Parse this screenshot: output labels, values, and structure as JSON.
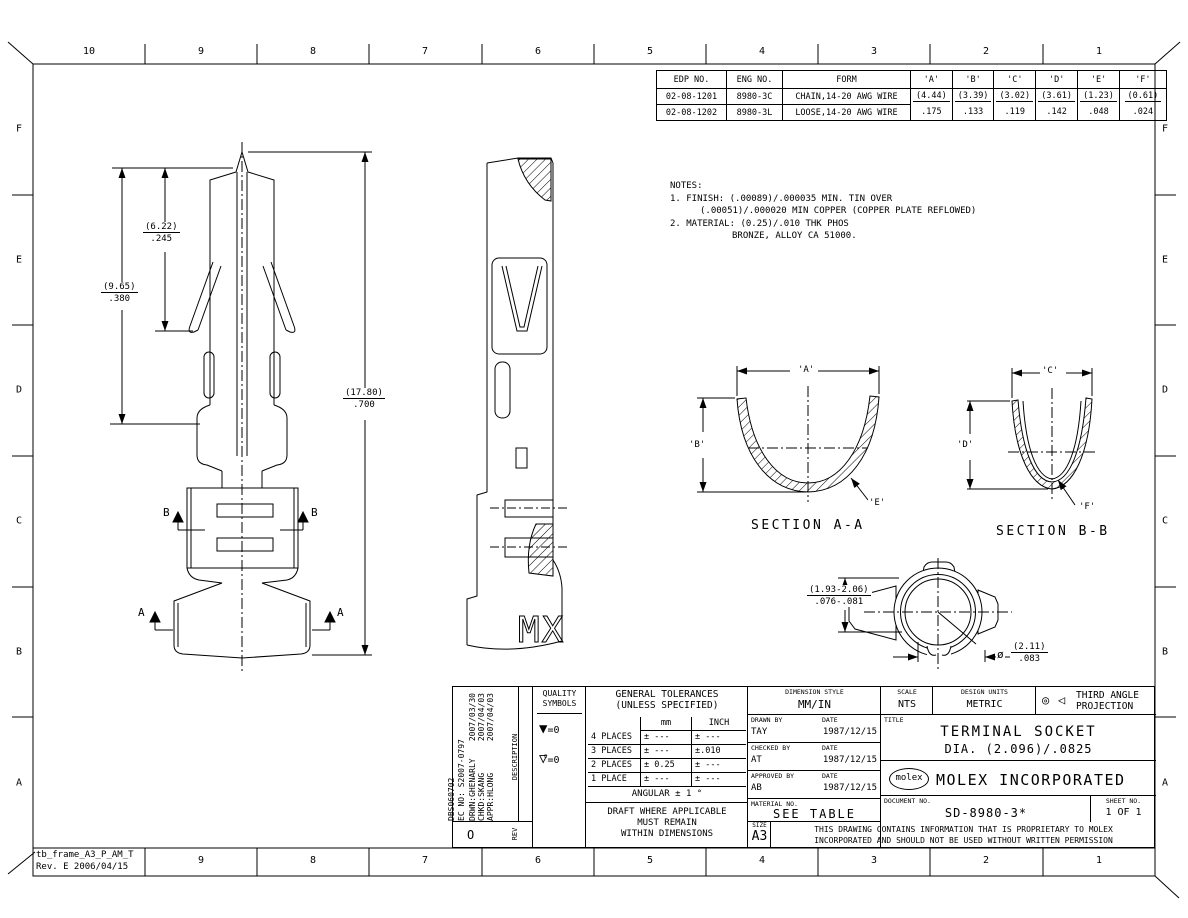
{
  "sheet": {
    "frame_label": "tb_frame_A3_P_AM_T",
    "frame_rev": "Rev. E 2006/04/15"
  },
  "grid": {
    "top": [
      "10",
      "9",
      "8",
      "7",
      "6",
      "5",
      "4",
      "3",
      "2",
      "1"
    ],
    "bottom": [
      "9",
      "8",
      "7",
      "6",
      "5",
      "4",
      "3",
      "2",
      "1"
    ],
    "letters": [
      "F",
      "E",
      "D",
      "C",
      "B",
      "A"
    ]
  },
  "edp_table": {
    "headers": [
      "EDP NO.",
      "ENG NO.",
      "FORM",
      "'A'",
      "'B'",
      "'C'",
      "'D'",
      "'E'",
      "'F'"
    ],
    "row1": [
      "02-08-1201",
      "8980-3C",
      "CHAIN,14-20 AWG WIRE",
      "(4.44)",
      "(3.39)",
      "(3.02)",
      "(3.61)",
      "(1.23)",
      "(0.61)"
    ],
    "row2": [
      "02-08-1202",
      "8980-3L",
      "LOOSE,14-20 AWG WIRE",
      ".175",
      ".133",
      ".119",
      ".142",
      ".048",
      ".024"
    ]
  },
  "notes": {
    "title": "NOTES:",
    "n1": "1. FINISH: (.00089)/.000035 MIN. TIN OVER",
    "n1b": "(.00051)/.000020 MIN COPPER (COPPER PLATE REFLOWED)",
    "n2": "2. MATERIAL: (0.25)/.010 THK PHOS",
    "n2b": "BRONZE, ALLOY CA 51000."
  },
  "dims": {
    "len1_mm": "(6.22)",
    "len1_in": ".245",
    "len2_mm": "(9.65)",
    "len2_in": ".380",
    "len3_mm": "(17.80)",
    "len3_in": ".700",
    "tab_mm": "(1.93-2.06)",
    "tab_in": ".076-.081",
    "dia_sym": "ø",
    "dia_mm": "(2.11)",
    "dia_in": ".083"
  },
  "front_view": {
    "b": "B",
    "a": "A"
  },
  "side_view": {
    "marking": "MX"
  },
  "sections": {
    "aa": "SECTION A-A",
    "bb": "SECTION B-B",
    "a": "'A'",
    "b": "'B'",
    "c": "'C'",
    "d": "'D'",
    "e": "'E'",
    "f": "'F'"
  },
  "title_block": {
    "rev": {
      "l1": "DBS060702",
      "l2": "EC NO: S2007-0797",
      "l3": "DRWN:GHENARLY",
      "d3": "2007/03/30",
      "l4": "CHKD:SKANG",
      "d4": "2007/04/03",
      "l5": "APPR:HLONG",
      "d5": "2007/04/03",
      "description": "DESCRIPTION",
      "rev": "REV",
      "mark": "O"
    },
    "quality": {
      "t1": "QUALITY",
      "t2": "SYMBOLS",
      "s1": "=0",
      "s2": "=0",
      "s2c": "C",
      "sym1": "▼",
      "sym2": "▽"
    },
    "tol": {
      "t1": "GENERAL TOLERANCES",
      "t2": "(UNLESS SPECIFIED)",
      "mm": "mm",
      "inch": "INCH",
      "rows": [
        [
          "4 PLACES",
          "± ---",
          "± ---"
        ],
        [
          "3 PLACES",
          "± ---",
          "±.010"
        ],
        [
          "2 PLACES",
          "± 0.25",
          "± ---"
        ],
        [
          "1 PLACE",
          "± ---",
          "± ---"
        ]
      ],
      "angular": "ANGULAR ± 1 °",
      "draft1": "DRAFT WHERE APPLICABLE",
      "draft2": "MUST REMAIN",
      "draft3": "WITHIN DIMENSIONS"
    },
    "info": {
      "style_label": "DIMENSION STYLE",
      "style": "MM/IN",
      "drawn_label": "DRAWN BY",
      "date_label": "DATE",
      "drawn": "TAY",
      "drawn_date": "1987/12/15",
      "checked_label": "CHECKED BY",
      "checked": "AT",
      "checked_date": "1987/12/15",
      "approved_label": "APPROVED BY",
      "approved": "AB",
      "approved_date": "1987/12/15",
      "material_label": "MATERIAL NO.",
      "material": "SEE TABLE"
    },
    "right": {
      "scale_label": "SCALE",
      "scale": "NTS",
      "units_label": "DESIGN UNITS",
      "units": "METRIC",
      "proj_sym1": "◎",
      "proj_sym2": "◁",
      "proj1": "THIRD ANGLE",
      "proj2": "PROJECTION",
      "title_label": "TITLE",
      "title1": "TERMINAL SOCKET",
      "title2": "DIA. (2.096)/.0825",
      "logo": "molex",
      "company": "MOLEX INCORPORATED",
      "doc_label": "DOCUMENT NO.",
      "doc": "SD-8980-3*",
      "sheet_label": "SHEET NO.",
      "sheet": "1 OF 1",
      "size_label": "SIZE",
      "size": "A3",
      "legal1": "THIS DRAWING CONTAINS INFORMATION THAT IS PROPRIETARY TO MOLEX",
      "legal2": "INCORPORATED AND SHOULD NOT BE USED WITHOUT WRITTEN PERMISSION"
    }
  }
}
